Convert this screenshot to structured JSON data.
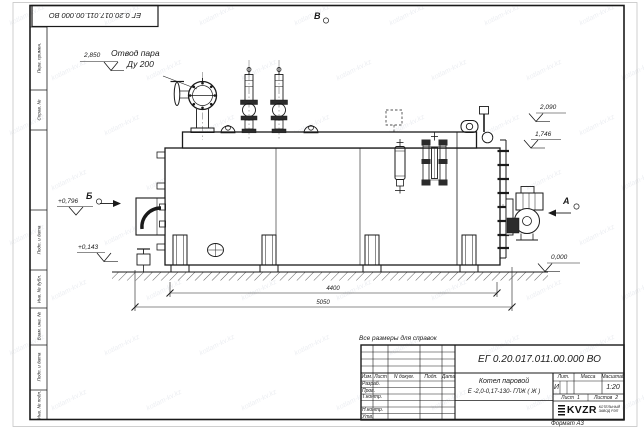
{
  "watermark": {
    "text": "kotlam-kv.kz"
  },
  "frame": {
    "doc_number_flipped": "ЕГ 0.20.017.011.00.000  ВО",
    "format_label": "Формат А3",
    "side_labels": [
      "Перв. примен.",
      "Справ. №",
      "Подп. и дата",
      "Инв. № дубл.",
      "Взам. инв. №",
      "Подп. и дата",
      "Инв. № подл."
    ]
  },
  "annotations": {
    "note": "Все размеры для справок",
    "steam_outlet_line1": "Отвод пара",
    "steam_outlet_line2": "Ду 200",
    "view_a": "А",
    "view_b": "Б",
    "view_v": "В",
    "elev_2850": "2,850",
    "elev_2090": "2,090",
    "elev_1746": "1,746",
    "elev_0000": "0,000",
    "elev_0796": "+0,796",
    "elev_0143": "+0,143",
    "dim_4400": "4400",
    "dim_5050": "5050"
  },
  "title_block": {
    "doc_number": "ЕГ 0.20.017.011.00.000  ВО",
    "product_name": "Котел паровой",
    "product_type": "Е -2,0-0,17-130- ГЛЖ ( Ж )",
    "col_izm": "Изм.",
    "col_list": "Лист",
    "col_doc": "N докум.",
    "col_podp": "Подп.",
    "col_data": "Дата",
    "row_razrab": "Разраб.",
    "row_prov": "Пров.",
    "row_tkontr": "Т.контр.",
    "row_nkontr": "Н.контр.",
    "row_utv": "Утв.",
    "lit_label": "Лит.",
    "mass_label": "Масса",
    "scale_label": "Масштаб",
    "lit_value": "И",
    "scale_value": "1:20",
    "sheet_label": "Лист",
    "sheet_value": "1",
    "sheets_label": "Листов",
    "sheets_value": "2",
    "company": "KVZR",
    "company_sub1": "КОТЕЛЬНЫЙ",
    "company_sub2": "ЗАВОД РЭП"
  },
  "colors": {
    "line": "#1a1a1a",
    "paper_edge": "#c4c4c4",
    "dark_fill": "#2b2b2b"
  }
}
